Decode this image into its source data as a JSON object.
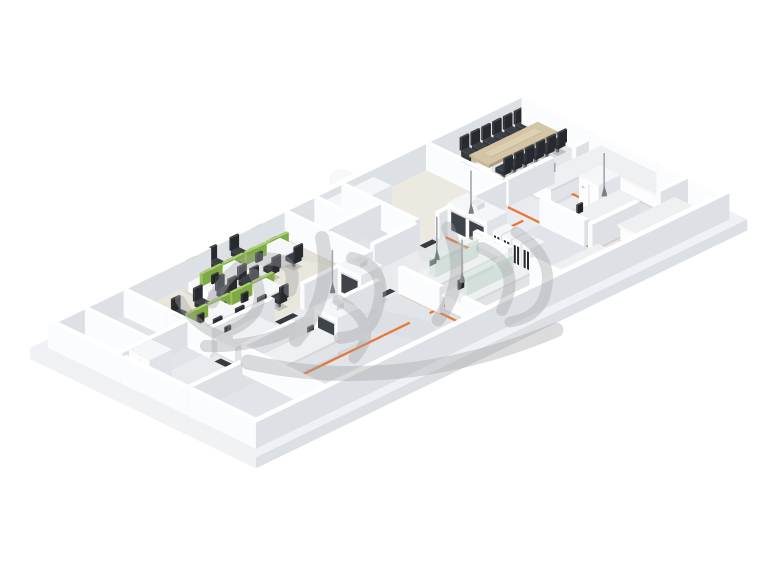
{
  "meta": {
    "description": "Isometric 3D rendering of a laboratory and office floor plan",
    "canvas_width": 760,
    "canvas_height": 570,
    "background": "#ffffff"
  },
  "palette": {
    "slabTop": "#eff1f4",
    "slabSideL": "#f1f2f4",
    "slabSideR": "#dcdfe3",
    "wallTop": "#ffffff",
    "wallL": "#fbfcfd",
    "wallR": "#dde0e4",
    "whiteTop": "#f5f6f8",
    "whiteL": "#fdfdfe",
    "whiteR": "#e0e3e7",
    "benchTop": "#eef0f2",
    "darkSeat": "#33373b",
    "darkTop": "#3c4045",
    "darkSide": "#26292d",
    "tanTop": "#d3c5a5",
    "tanL": "#c8b995",
    "tanR": "#af9f7e",
    "greenTop": "#abd06f",
    "greenL": "#99c35a",
    "greenR": "#7fa944",
    "glassTop": "rgba(226,238,231,0.55)",
    "glassL": "rgba(204,224,213,0.5)",
    "glassR": "rgba(182,205,194,0.5)",
    "window": "#3f444a",
    "sash": "#dfe3e6",
    "orange": "#e8722e",
    "mat": "#202225",
    "metal": "#a2a7ac",
    "metalDark": "#7a7f85",
    "sweep": "#bfc3c8",
    "watermark": "#a4a4a6"
  },
  "watermark": {
    "label": "illegible-gray-calligraphy-watermark",
    "opacity": 0.38,
    "strokes": [
      {
        "d": "M212 302 Q236 252 278 260 Q298 266 290 290",
        "w": 13
      },
      {
        "d": "M232 330 Q272 312 254 274",
        "w": 11
      },
      {
        "d": "M206 346 Q262 348 306 322",
        "w": 12
      },
      {
        "d": "M180 300 Q196 330 228 338",
        "w": 10
      },
      {
        "d": "M322 238 Q334 296 296 340",
        "w": 14
      },
      {
        "d": "M352 258 Q394 268 374 318 Q366 336 340 338",
        "w": 12
      },
      {
        "d": "M338 300 Q384 326 354 358",
        "w": 11
      },
      {
        "d": "M448 228 Q470 278 438 320",
        "w": 13
      },
      {
        "d": "M482 248 Q524 266 502 310",
        "w": 12
      },
      {
        "d": "M516 232 Q558 258 544 298 Q536 318 510 322",
        "w": 11
      },
      {
        "d": "M248 362 Q398 396 556 330",
        "w": 15
      }
    ]
  },
  "scene": {
    "origin": {
      "x": 30,
      "y": 348
    },
    "iso": {
      "ux": 0.9,
      "uy": -0.436,
      "vx": 0.9,
      "vy": 0.436
    },
    "floor": {
      "u": 546,
      "v": 251,
      "thickness": 11
    },
    "wall_height": 26,
    "rooms": [
      {
        "name": "interior-floor",
        "u": 16,
        "v": 16,
        "du": 514,
        "dv": 219,
        "fill": "#e1e4e8"
      },
      {
        "name": "corridor-floor",
        "u": 16,
        "v": 104,
        "du": 514,
        "dv": 38,
        "fill": "#e9ebee"
      },
      {
        "name": "office-carpet",
        "u": 93,
        "v": 16,
        "du": 174,
        "dv": 88,
        "fill": "#e9e6dc"
      },
      {
        "name": "storage-room-floor",
        "u": 335,
        "v": 16,
        "du": 89,
        "dv": 82,
        "fill": "#ece9e0"
      },
      {
        "name": "conference-room-floor",
        "u": 429,
        "v": 16,
        "du": 101,
        "dv": 82,
        "fill": "#e5e7ea"
      }
    ],
    "sweeps": [
      {
        "d": "M250 250 Q320 238 360 268 Q382 284 368 302",
        "w": 26,
        "op": 0.16
      },
      {
        "d": "M300 332 Q360 310 424 332",
        "w": 22,
        "op": 0.14
      },
      {
        "d": "M428 252 Q478 238 522 262",
        "w": 20,
        "op": 0.13
      },
      {
        "d": "M184 282 Q222 300 210 332",
        "w": 18,
        "op": 0.14
      },
      {
        "d": "M340 180 Q392 196 378 236",
        "w": 22,
        "op": 0.12
      }
    ],
    "walls": [
      {
        "u": 10,
        "v": 10,
        "du": 526,
        "dv": 6
      },
      {
        "u": 530,
        "v": 16,
        "du": 6,
        "dv": 225
      },
      {
        "u": 10,
        "v": 16,
        "du": 6,
        "dv": 225
      },
      {
        "u": 10,
        "v": 235,
        "du": 526,
        "dv": 6
      },
      {
        "u": 88,
        "v": 16,
        "du": 5,
        "dv": 96
      },
      {
        "u": 88,
        "v": 148,
        "du": 5,
        "dv": 87
      },
      {
        "u": 16,
        "v": 82,
        "du": 72,
        "dv": 5
      },
      {
        "u": 16,
        "v": 160,
        "du": 72,
        "dv": 5
      },
      {
        "u": 45,
        "v": 16,
        "du": 5,
        "dv": 66
      },
      {
        "u": 93,
        "v": 104,
        "du": 70,
        "dv": 5
      },
      {
        "u": 196,
        "v": 104,
        "du": 71,
        "dv": 5
      },
      {
        "u": 267,
        "v": 16,
        "du": 5,
        "dv": 93
      },
      {
        "u": 93,
        "v": 142,
        "du": 55,
        "dv": 5
      },
      {
        "u": 183,
        "v": 142,
        "du": 60,
        "dv": 5
      },
      {
        "u": 267,
        "v": 142,
        "du": 5,
        "dv": 46
      },
      {
        "u": 267,
        "v": 212,
        "du": 5,
        "dv": 23
      },
      {
        "u": 350,
        "v": 142,
        "du": 5,
        "dv": 40
      },
      {
        "u": 350,
        "v": 205,
        "du": 5,
        "dv": 30
      },
      {
        "u": 280,
        "v": 98,
        "du": 48,
        "dv": 5
      },
      {
        "u": 352,
        "v": 98,
        "du": 74,
        "dv": 5
      },
      {
        "u": 429,
        "v": 98,
        "du": 51,
        "dv": 5
      },
      {
        "u": 504,
        "v": 98,
        "du": 26,
        "dv": 5
      },
      {
        "u": 424,
        "v": 16,
        "du": 5,
        "dv": 82
      },
      {
        "u": 330,
        "v": 16,
        "du": 5,
        "dv": 82
      },
      {
        "u": 424,
        "v": 142,
        "du": 5,
        "dv": 50
      },
      {
        "u": 424,
        "v": 196,
        "du": 52,
        "dv": 5
      },
      {
        "u": 500,
        "v": 196,
        "du": 30,
        "dv": 5
      },
      {
        "u": 272,
        "v": 55,
        "du": 58,
        "dv": 5
      },
      {
        "u": 300,
        "v": 16,
        "du": 5,
        "dv": 39
      }
    ],
    "orange_lines": [
      {
        "pts": [
          [
            98,
            152
          ],
          [
            196,
            152
          ]
        ]
      },
      {
        "pts": [
          [
            98,
            182
          ],
          [
            240,
            182
          ]
        ]
      },
      {
        "pts": [
          [
            270,
            144
          ],
          [
            348,
            144
          ]
        ]
      },
      {
        "pts": [
          [
            262,
            182
          ],
          [
            348,
            182
          ]
        ]
      },
      {
        "pts": [
          [
            270,
            212
          ],
          [
            350,
            212
          ]
        ]
      },
      {
        "pts": [
          [
            356,
            128
          ],
          [
            420,
            128
          ]
        ]
      },
      {
        "pts": [
          [
            430,
            160
          ],
          [
            528,
            160
          ]
        ]
      },
      {
        "pts": [
          [
            430,
            200
          ],
          [
            496,
            200
          ]
        ]
      },
      {
        "pts": [
          [
            430,
            230
          ],
          [
            520,
            230
          ]
        ]
      },
      {
        "pts": [
          [
            358,
            104
          ],
          [
            358,
            214
          ]
        ]
      },
      {
        "pts": [
          [
            427,
            104
          ],
          [
            427,
            232
          ]
        ]
      },
      {
        "pts": [
          [
            268,
            144
          ],
          [
            268,
            232
          ]
        ]
      },
      {
        "pts": [
          [
            478,
            98
          ],
          [
            478,
            158
          ]
        ]
      }
    ],
    "mats": [
      [
        166,
        106,
        20,
        6
      ],
      [
        158,
        143,
        18,
        6
      ],
      [
        250,
        132,
        18,
        6
      ],
      [
        334,
        99,
        14,
        6
      ],
      [
        482,
        99,
        14,
        6
      ],
      [
        300,
        226,
        18,
        6
      ],
      [
        440,
        228,
        18,
        6
      ],
      [
        352,
        186,
        12,
        6
      ],
      [
        87,
        118,
        7,
        16
      ]
    ],
    "furniture": [
      {
        "type": "table",
        "name": "conference-table",
        "u": 450,
        "v": 38,
        "du": 76,
        "dv": 22,
        "chairs_per_side": 6,
        "end_chairs": 1
      },
      {
        "type": "deskrow",
        "name": "office-desk-row",
        "u": 98,
        "v": 62,
        "du": 102,
        "dv": 22,
        "seats_per_side": 4
      },
      {
        "type": "deskrow",
        "name": "office-desk-row",
        "u": 152,
        "v": 24,
        "du": 102,
        "dv": 22,
        "seats_per_side": 4
      },
      {
        "type": "bench",
        "name": "lab-bench",
        "u": 455,
        "v": 104,
        "du": 75,
        "dv": 20
      },
      {
        "type": "bench",
        "name": "lab-bench",
        "u": 508,
        "v": 126,
        "du": 22,
        "dv": 64
      },
      {
        "type": "tallunit",
        "name": "lab-refrigerator",
        "u": 468,
        "v": 142,
        "du": 24,
        "dv": 22
      },
      {
        "type": "tallunit",
        "name": "lab-refrigerator",
        "u": 18,
        "v": 92,
        "du": 25,
        "dv": 23
      },
      {
        "type": "fumehood",
        "name": "fume-hood",
        "u": 360,
        "v": 104,
        "du": 22,
        "dv": 44,
        "windows": 2
      },
      {
        "type": "fumehood",
        "name": "fume-hood",
        "u": 166,
        "v": 150,
        "du": 24,
        "dv": 26,
        "windows": 1
      },
      {
        "type": "fumehood",
        "name": "fume-hood",
        "u": 228,
        "v": 114,
        "du": 24,
        "dv": 26,
        "windows": 1
      },
      {
        "type": "bench",
        "name": "lab-bench-reagent-shelf",
        "u": 278,
        "v": 148,
        "du": 68,
        "dv": 22,
        "glass": true
      },
      {
        "type": "bench",
        "name": "lab-bench-reagent-shelf",
        "u": 275,
        "v": 186,
        "du": 72,
        "dv": 22,
        "glass": true
      },
      {
        "type": "bench",
        "name": "lab-bench",
        "u": 98,
        "v": 156,
        "du": 66,
        "dv": 22
      },
      {
        "type": "bench",
        "name": "lab-bench",
        "u": 98,
        "v": 110,
        "du": 46,
        "dv": 20
      },
      {
        "type": "gascabs",
        "name": "gas-cylinder-cabinet",
        "u": 362,
        "v": 152,
        "count": 4
      },
      {
        "type": "bench",
        "name": "lab-bench",
        "u": 434,
        "v": 165,
        "du": 56,
        "dv": 22
      },
      {
        "type": "bench",
        "name": "lab-bench",
        "u": 452,
        "v": 204,
        "du": 60,
        "dv": 20
      },
      {
        "type": "bench",
        "name": "lab-bench",
        "u": 360,
        "v": 215,
        "du": 56,
        "dv": 18
      },
      {
        "type": "cabinet",
        "name": "storage-cabinet",
        "u": 306,
        "v": 20,
        "du": 22,
        "dv": 20
      },
      {
        "type": "cabinet",
        "name": "storage-cabinet",
        "u": 338,
        "v": 20,
        "du": 24,
        "dv": 20
      },
      {
        "type": "monitor",
        "name": "bench-monitor",
        "u": 294,
        "v": 150
      },
      {
        "type": "monitor",
        "name": "bench-monitor",
        "u": 440,
        "v": 167
      },
      {
        "type": "monitor",
        "name": "bench-monitor",
        "u": 104,
        "v": 112
      },
      {
        "type": "monitor",
        "name": "bench-monitor",
        "u": 470,
        "v": 106
      },
      {
        "type": "monitor",
        "name": "bench-monitor",
        "u": 150,
        "v": 158
      },
      {
        "type": "monitor",
        "name": "bench-monitor",
        "u": 287,
        "v": 188
      },
      {
        "type": "sink",
        "name": "bench-sink",
        "u": 512,
        "v": 146
      }
    ],
    "snorkels": [
      [
        310,
        142
      ],
      [
        298,
        182
      ],
      [
        476,
        162
      ],
      [
        214,
        122
      ],
      [
        382,
        108
      ]
    ]
  }
}
